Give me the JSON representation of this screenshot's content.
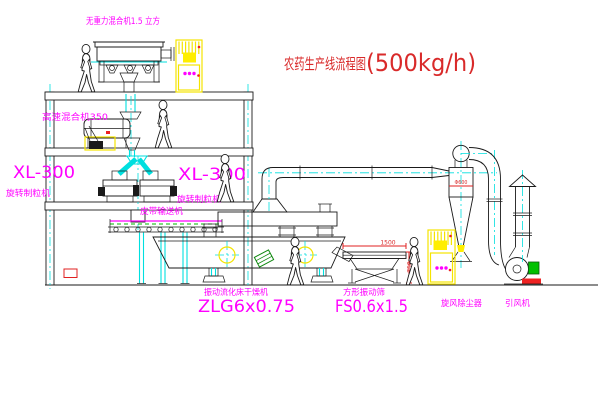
{
  "title": {
    "text": "农药生产线流程图",
    "capacity": "(500kg/h)"
  },
  "labels": {
    "gravity_free_mixer": "无重力混合机1.5 立方",
    "high_speed_mixer": "高速混合机350",
    "granulator_left_model": "XL-300",
    "granulator_left_name": "旋转制粒机",
    "granulator_center_model": "XL-300",
    "granulator_center_name": "旋转制粒机",
    "belt_conveyor": "皮带输送机",
    "dryer_name": "振动流化床干燥机",
    "dryer_model": "ZLG6x0.75",
    "sieve_name": "方形振动筛",
    "sieve_model": "FS0.6x1.5",
    "cyclone": "旋风除尘器",
    "induced_draft_fan": "引风机"
  },
  "dimensions": {
    "sieve_length": "1500",
    "sieve_height": "750",
    "cyclone_diameter": "Φ600"
  },
  "colors": {
    "line": "#1a1a1a",
    "centerline": "#00dfdf",
    "label": "#ff00ff",
    "title": "#d92a2a",
    "cabinet_yellow": "#f5e400",
    "alert_red": "#ee2222",
    "machine_green": "#00b400"
  }
}
